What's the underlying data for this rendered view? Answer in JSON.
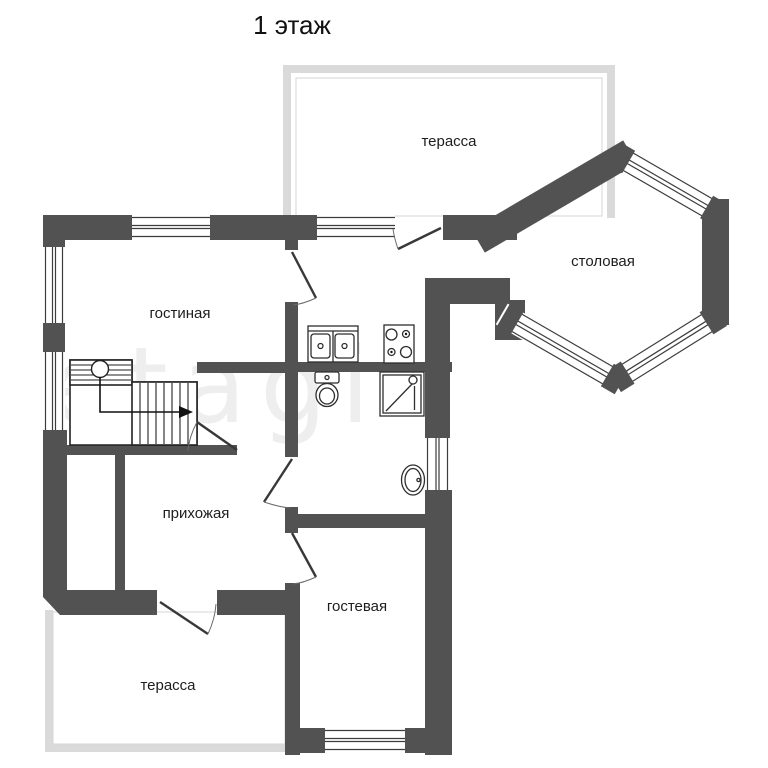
{
  "title": "1 этаж",
  "watermark": "etagi",
  "colors": {
    "wall": "#525252",
    "terrace_wall": "#dadada",
    "window_line": "#3c3c3c",
    "text": "#1d1d1d",
    "watermark": "#eeeeee",
    "background": "#ffffff"
  },
  "rooms": {
    "terrace_top": {
      "label": "терасса"
    },
    "dining": {
      "label": "столовая"
    },
    "living": {
      "label": "гостиная"
    },
    "hallway": {
      "label": "прихожая"
    },
    "guest": {
      "label": "гостевая"
    },
    "terrace_bottom": {
      "label": "терасса"
    }
  }
}
